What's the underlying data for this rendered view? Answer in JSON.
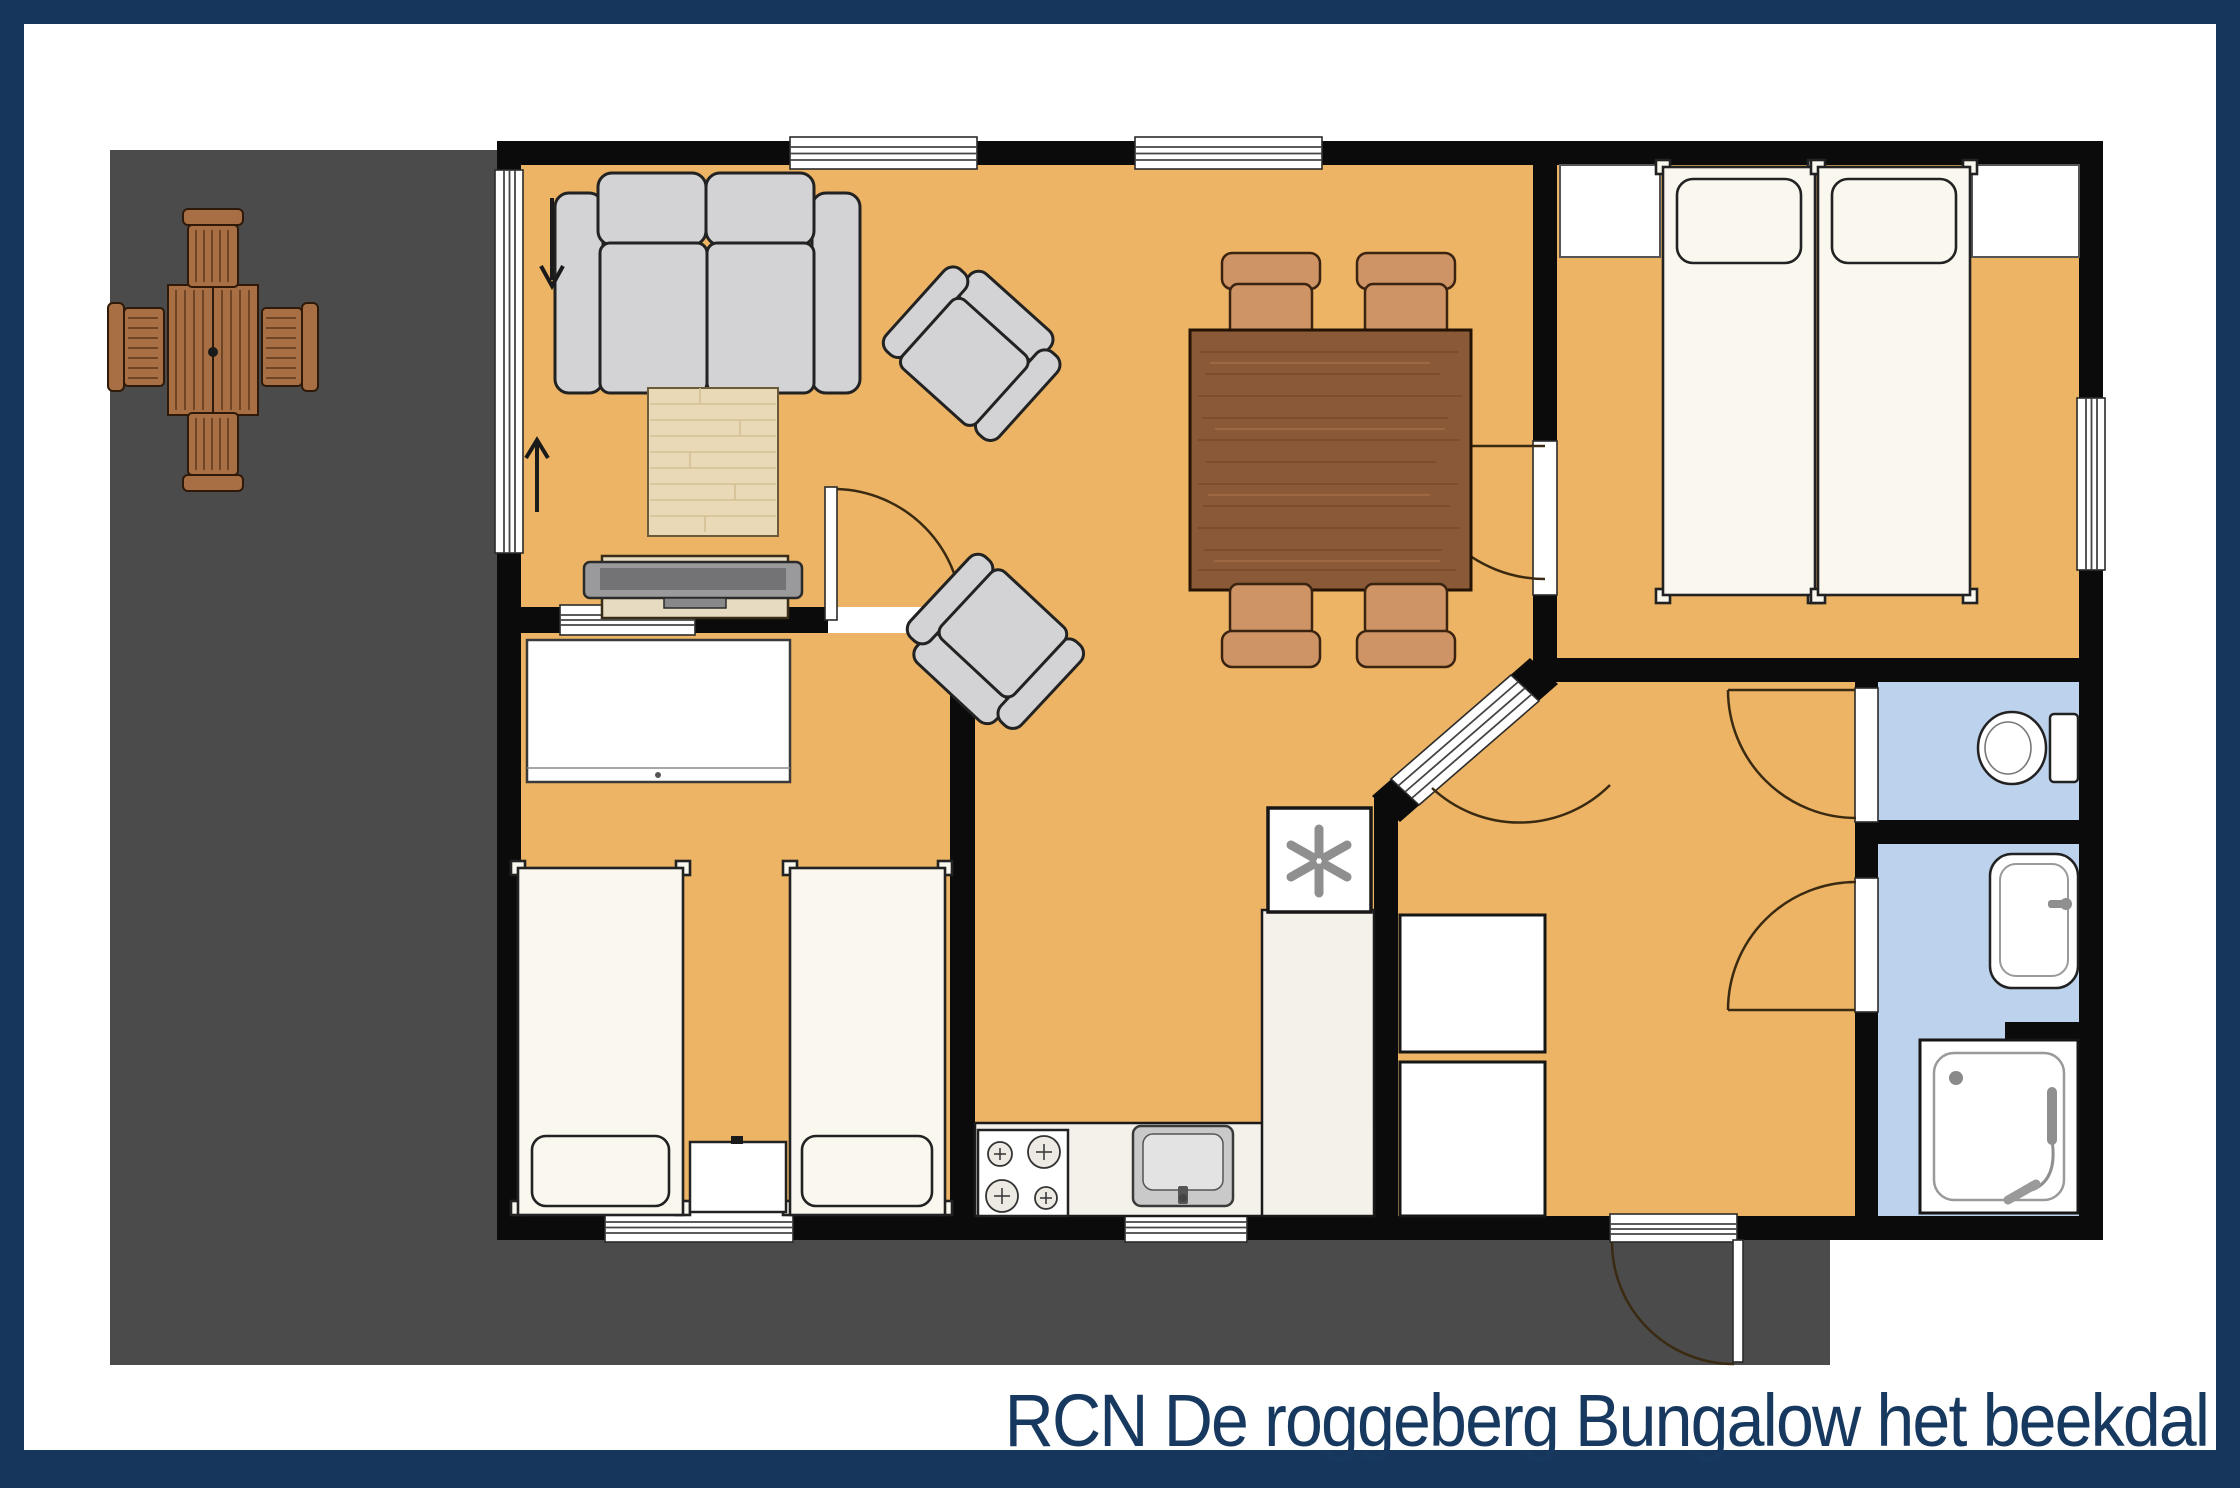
{
  "title": {
    "text": "RCN De roggeberg Bungalow het beekdal"
  },
  "colors": {
    "border": "#16365c",
    "white": "#ffffff",
    "terrace": "#4b4b4b",
    "wall": "#0b0b0b",
    "floor": "#ecb464",
    "wet": "#bdd2ec",
    "paper": "#faf7ef",
    "furn_gray": "#d3d3d5",
    "outline": "#222222",
    "counter": "#f3f1ea",
    "rug": "#ead9b6",
    "rug_line": "#d5bf94",
    "dining_wood": "#8a5a38",
    "chair_tan": "#cf9465",
    "patio_wood": "#a96f44",
    "patio_slat": "#6f4526",
    "arc": "#3b2a12",
    "icon_gray": "#8f8f8f",
    "tv": "#9a9a9c",
    "tv_screen": "#737375",
    "cabinet": "#e7dcc2",
    "title": "#17395f"
  },
  "icons": {
    "refrigerator": "✳",
    "entry_arrow_down": "↓",
    "entry_arrow_up": "↑"
  }
}
